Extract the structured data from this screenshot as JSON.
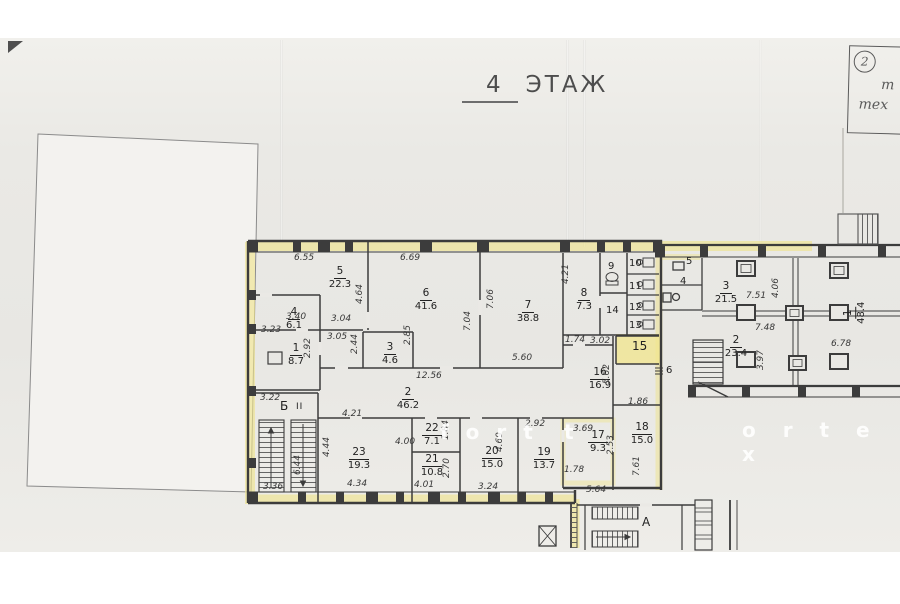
{
  "title": {
    "floor_number": "4",
    "floor_word": "ЭТАЖ"
  },
  "stamp": {
    "number": "2",
    "line1": "т",
    "line2": "тех"
  },
  "watermark": {
    "left": "f o r t",
    "mid": "t",
    "right": "o r t e x"
  },
  "colors": {
    "highlight": "#f0e68c",
    "wall": "#3c3c3c",
    "paper": "#e9e8e4"
  },
  "plan": {
    "left_block": {
      "rooms": {
        "r1": {
          "num": "1",
          "area": "8.7"
        },
        "r2": {
          "num": "2",
          "area": "46.2"
        },
        "r3": {
          "num": "3",
          "area": "4.6"
        },
        "r4": {
          "num": "4",
          "area": "6.1"
        },
        "r5": {
          "num": "5",
          "area": "22.3"
        },
        "r6": {
          "num": "6",
          "area": "41.6"
        },
        "r7": {
          "num": "7",
          "area": "38.8"
        },
        "r8": {
          "num": "8",
          "area": "7.3"
        },
        "r9": {
          "num": "9"
        },
        "r10": {
          "num": "10"
        },
        "r11": {
          "num": "11"
        },
        "r12": {
          "num": "12"
        },
        "r13": {
          "num": "13"
        },
        "r14": {
          "num": "14"
        },
        "r15": {
          "num": "15"
        },
        "r16": {
          "num": "16",
          "area": "16.9"
        },
        "r17": {
          "num": "17",
          "area": "9.3"
        },
        "r18": {
          "num": "18",
          "area": "15.0"
        },
        "r19": {
          "num": "19",
          "area": "13.7"
        },
        "r20": {
          "num": "20",
          "area": "15.0"
        },
        "r21": {
          "num": "21",
          "area": "10.8"
        },
        "r22": {
          "num": "22",
          "area": "7.1"
        },
        "r23": {
          "num": "23",
          "area": "19.3"
        }
      },
      "stair_label": "Б",
      "stair_mark": "II"
    },
    "right_wing": {
      "rooms": {
        "w1": {
          "num": "1",
          "area": "48.4"
        },
        "w2": {
          "num": "2",
          "area": "23.4"
        },
        "w3": {
          "num": "3",
          "area": "21.5"
        },
        "w4": {
          "num": "4"
        },
        "w5": {
          "num": "5"
        },
        "w6": {
          "num": "6"
        }
      }
    },
    "lower_section": {
      "stair_label": "А"
    },
    "dims": [
      "6.55",
      "6.69",
      "3.40",
      "3.23",
      "2.92",
      "3.04",
      "3.05",
      "2.44",
      "4.64",
      "2.85",
      "12.56",
      "5.60",
      "7.06",
      "7.04",
      "4.21",
      "1.74",
      "3.02",
      "5.62",
      "1.86",
      "3.69",
      "2.53",
      "1.78",
      "5.64",
      "7.61",
      "2.92",
      "4.69",
      "3.24",
      "1.84",
      "2.70",
      "4.00",
      "4.01",
      "4.21",
      "4.44",
      "4.34",
      "3.22",
      "3.36",
      "6.44",
      "7.51",
      "7.48",
      "4.06",
      "3.97",
      "6.78"
    ]
  }
}
